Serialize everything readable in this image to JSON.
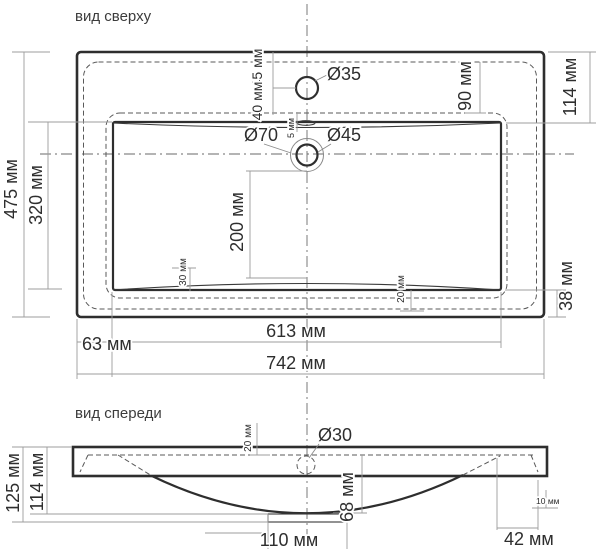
{
  "drawing": {
    "top_view": {
      "title": "вид сверху",
      "labels": {
        "width_overall": "742 мм",
        "width_basin": "613 мм",
        "left_offset": "63 мм",
        "depth_overall": "475 мм",
        "depth_basin": "320 мм",
        "back_to_overflow": "45 мм",
        "overflow_to_rim": "40 мм",
        "rim_gap": "5 мм",
        "overflow_hole": "Ø35",
        "faucet_outer": "Ø70",
        "faucet_inner": "Ø45",
        "back_inset": "90 мм",
        "back_inset_right": "114 мм",
        "faucet_to_front": "200 мм",
        "left_slope": "30 мм",
        "right_slope": "20 мм",
        "front_inset": "38 мм"
      }
    },
    "front_view": {
      "title": "вид спереди",
      "labels": {
        "rim_drop": "20 мм",
        "drain_hole": "Ø30",
        "height_overall": "125 мм",
        "height_bowl": "114 мм",
        "bowl_depth": "68 мм",
        "edge_thickness": "10 мм",
        "drain_width": "110 мм",
        "right_offset": "42 мм"
      }
    }
  },
  "colors": {
    "background": "#ffffff",
    "main_line": "#2e2e2e",
    "hidden_line": "#5a5a5a",
    "dimension_line": "#9c9c9c",
    "text": "#2e2e2e"
  }
}
